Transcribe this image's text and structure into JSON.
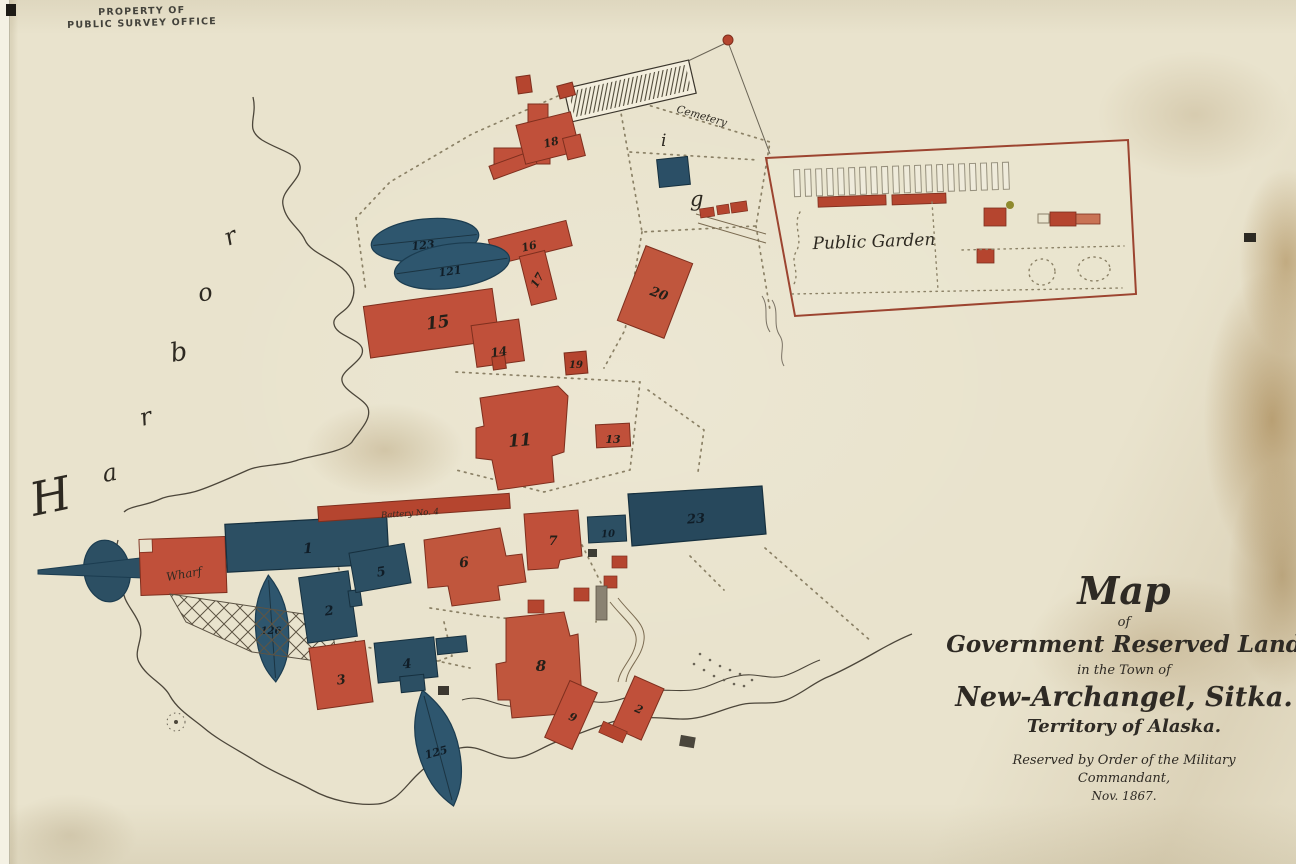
{
  "stamp": {
    "line1": "PROPERTY OF",
    "line2": "PUBLIC SURVEY OFFICE"
  },
  "harbor": {
    "letters": [
      "H",
      "a",
      "r",
      "b",
      "o",
      "r"
    ]
  },
  "labels": {
    "cemetery": "Cemetery",
    "public_garden": "Public Garden",
    "wharf": "Wharf",
    "battery": "Battery No. 4",
    "letter_i": "i",
    "letter_g": "g"
  },
  "buildings": {
    "b1": "1",
    "b2": "2",
    "b3": "3",
    "b4": "4",
    "b5": "5",
    "b6": "6",
    "b7": "7",
    "b8": "8",
    "b9": "9",
    "b9b": "2",
    "b10": "10",
    "b11": "11",
    "b13": "13",
    "b14": "14",
    "b15": "15",
    "b16": "16",
    "b17": "17",
    "b18": "18",
    "b19": "19",
    "b20": "20",
    "b23": "23",
    "boat121": "121",
    "boat123": "123",
    "boat125": "125",
    "boat126": "126"
  },
  "title_block": {
    "line1": "Map",
    "line2": "of",
    "line3": "Government Reserved Land",
    "line4": "in the Town of",
    "line5": "New-Archangel, Sitka.",
    "line6": "Territory of Alaska.",
    "line7": "Reserved by Order of the Military",
    "line8": "Commandant,",
    "line9": "Nov. 1867."
  }
}
